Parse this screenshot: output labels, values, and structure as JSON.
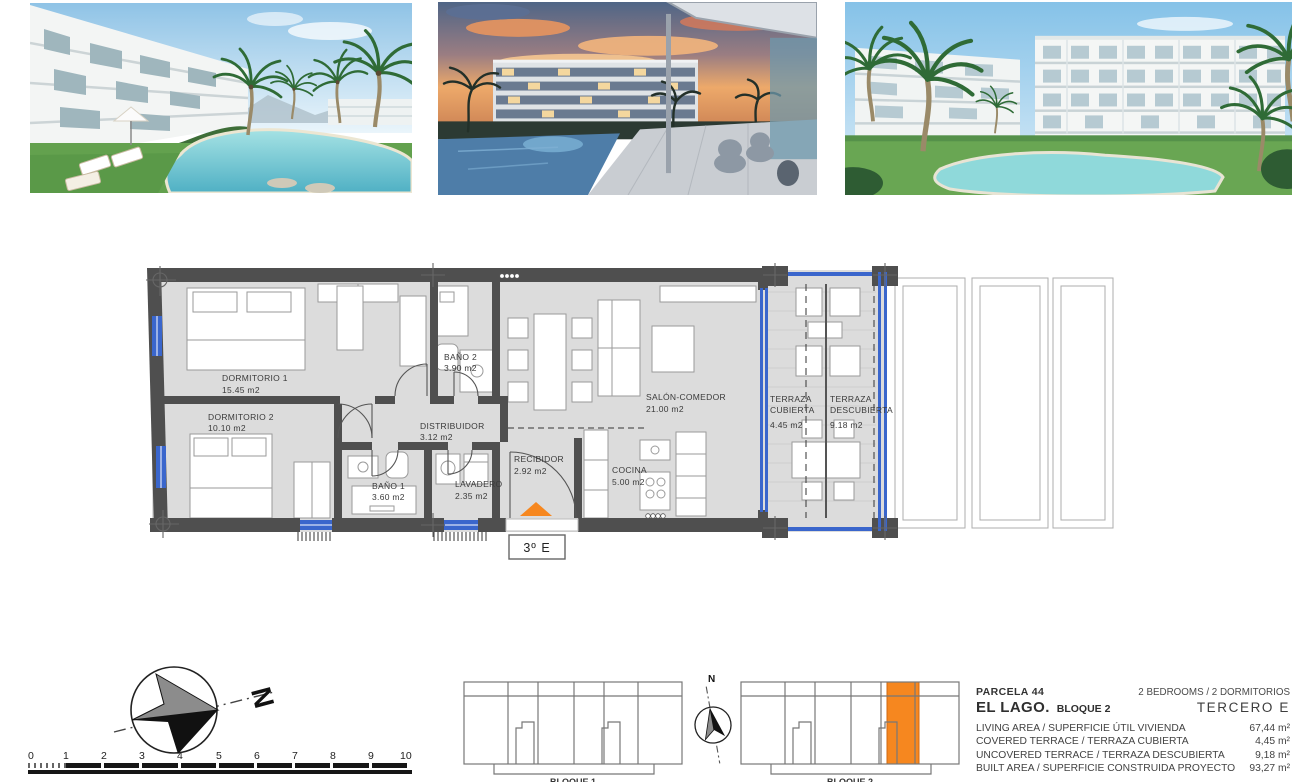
{
  "floorplan": {
    "unit_box_label": "3º E",
    "rooms": [
      {
        "name": "DORMITORIO 1",
        "area": "15.45 m2"
      },
      {
        "name": "DORMITORIO 2",
        "area": "10.10 m2"
      },
      {
        "name": "BAÑO 2",
        "area": "3.90 m2"
      },
      {
        "name": "DISTRIBUIDOR",
        "area": "3.12 m2"
      },
      {
        "name": "BAÑO 1",
        "area": "3.60 m2"
      },
      {
        "name": "LAVADERO",
        "area": "2.35 m2"
      },
      {
        "name": "RECIBIDOR",
        "area": "2.92 m2"
      },
      {
        "name": "COCINA",
        "area": "5.00 m2"
      },
      {
        "name": "SALÓN-COMEDOR",
        "area": "21.00 m2"
      },
      {
        "name": "TERRAZA",
        "name2": "CUBIERTA",
        "area": "4.45 m2"
      },
      {
        "name": "TERRAZA",
        "name2": "DESCUBIERTA",
        "area": "9.18 m2"
      }
    ]
  },
  "compass": {
    "north_label": "N"
  },
  "mini_compass": {
    "north_label": "N"
  },
  "scale_bar": {
    "ticks": [
      "0",
      "1",
      "2",
      "3",
      "4",
      "5",
      "6",
      "7",
      "8",
      "9",
      "10"
    ]
  },
  "key_plans": {
    "block1_label": "BLOQUE 1",
    "block2_label": "BLOQUE 2"
  },
  "summary": {
    "parcel": "PARCELA  44",
    "bedrooms": "2 BEDROOMS / 2 DORMITORIOS",
    "project": "EL LAGO.",
    "block": "BLOQUE 2",
    "floor_unit": "TERCERO  E",
    "rows": [
      {
        "label": "LIVING AREA / SUPERFICIE ÚTIL VIVIENDA",
        "value": "67,44 m²"
      },
      {
        "label": "COVERED TERRACE / TERRAZA CUBIERTA",
        "value": "4,45 m²"
      },
      {
        "label": "UNCOVERED TERRACE / TERRAZA DESCUBIERTA",
        "value": "9,18 m²"
      },
      {
        "label": "BUILT AREA / SUPERFICIE CONSTRUIDA PROYECTO",
        "value": "93,27 m²"
      }
    ]
  },
  "colors": {
    "accent_orange": "#F6871F",
    "wall_gray": "#4F4F4F",
    "floor_gray": "#DCDCDC",
    "glass_blue": "#3A66CC"
  }
}
